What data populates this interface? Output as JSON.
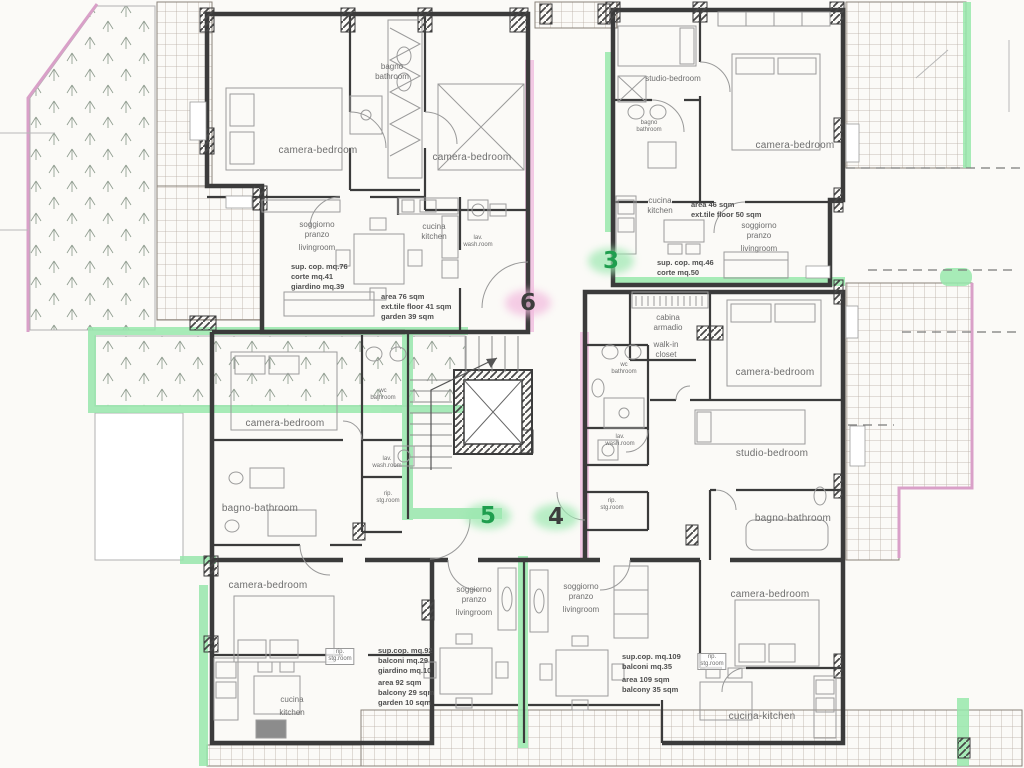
{
  "palette": {
    "wall": "#3b3b3b",
    "label_gray": "#6e6e6e",
    "stats_gray": "#4f4f4f",
    "green_highlight": "#98e7ac",
    "pink_highlight": "#f0c0e0",
    "pink_border": "#d9a0c8",
    "badge_green": "#1f9e4e",
    "badge_dark": "#3d3d3d",
    "grid_line": "#b6aca2",
    "paper": "#fbfaf7"
  },
  "badges": [
    {
      "name": "unit-badge-6",
      "value": "6",
      "x": 528,
      "y": 303,
      "color": "dark",
      "halo": "#f2b9dd"
    },
    {
      "name": "unit-badge-3",
      "value": "3",
      "x": 611,
      "y": 261,
      "color": "green",
      "halo": "#9ce8b0"
    },
    {
      "name": "unit-badge-5",
      "value": "5",
      "x": 488,
      "y": 516,
      "color": "green",
      "halo": "#9ce8b0"
    },
    {
      "name": "unit-badge-4",
      "value": "4",
      "x": 556,
      "y": 517,
      "color": "dark",
      "halo": "#9ce8b0"
    }
  ],
  "labels": [
    {
      "name": "label-bedroom-nw-left",
      "lines": [
        "camera-bedroom"
      ],
      "x": 318,
      "y": 145,
      "cls": "room"
    },
    {
      "name": "label-bath-nw",
      "lines": [
        "bagno",
        "bathroom"
      ],
      "x": 392,
      "y": 62,
      "cls": "small"
    },
    {
      "name": "label-bedroom-nw-right",
      "lines": [
        "camera-bedroom"
      ],
      "x": 472,
      "y": 152,
      "cls": "room"
    },
    {
      "name": "label-living-nw",
      "lines": [
        "soggiorno",
        "pranzo",
        "",
        "livingroom"
      ],
      "x": 317,
      "y": 220,
      "cls": "small"
    },
    {
      "name": "label-kitchen-nw",
      "lines": [
        "cucina",
        "kitchen"
      ],
      "x": 434,
      "y": 222,
      "cls": "small"
    },
    {
      "name": "label-washroom-nw",
      "lines": [
        "lav.",
        "wash.room"
      ],
      "x": 478,
      "y": 235,
      "cls": "tiny"
    },
    {
      "name": "label-stats-nw-it",
      "lines": [
        "sup. cop. mq.76",
        "corte mq.41",
        "giardino mq.39"
      ],
      "x": 291,
      "y": 262,
      "cls": "stats"
    },
    {
      "name": "label-stats-nw-en",
      "lines": [
        "area 76 sqm",
        "ext.tile floor 41 sqm",
        "garden 39 sqm"
      ],
      "x": 381,
      "y": 292,
      "cls": "stats"
    },
    {
      "name": "label-studio-ne",
      "lines": [
        "studio-bedroom"
      ],
      "x": 673,
      "y": 74,
      "cls": "small"
    },
    {
      "name": "label-bath-ne",
      "lines": [
        "bagno",
        "bathroom"
      ],
      "x": 649,
      "y": 120,
      "cls": "tiny"
    },
    {
      "name": "label-bedroom-ne",
      "lines": [
        "camera-bedroom"
      ],
      "x": 795,
      "y": 140,
      "cls": "room"
    },
    {
      "name": "label-kitchen-ne",
      "lines": [
        "cucina",
        "kitchen"
      ],
      "x": 660,
      "y": 196,
      "cls": "small"
    },
    {
      "name": "label-stats-ne-en",
      "lines": [
        "area 46 sqm",
        "ext.tile floor 50 sqm"
      ],
      "x": 691,
      "y": 200,
      "cls": "stats"
    },
    {
      "name": "label-living-ne",
      "lines": [
        "soggiorno",
        "pranzo",
        "",
        "livingroom"
      ],
      "x": 759,
      "y": 221,
      "cls": "small"
    },
    {
      "name": "label-stats-ne-it",
      "lines": [
        "sup. cop. mq.46",
        "corte mq.50"
      ],
      "x": 657,
      "y": 258,
      "cls": "stats"
    },
    {
      "name": "label-closet-e-it",
      "lines": [
        "cabina",
        "armadio"
      ],
      "x": 668,
      "y": 313,
      "cls": "small"
    },
    {
      "name": "label-closet-e-en",
      "lines": [
        "walk-in",
        "closet"
      ],
      "x": 666,
      "y": 340,
      "cls": "small"
    },
    {
      "name": "label-wc-e",
      "lines": [
        "wc",
        "bathroom"
      ],
      "x": 624,
      "y": 362,
      "cls": "tiny"
    },
    {
      "name": "label-bedroom-e",
      "lines": [
        "camera-bedroom"
      ],
      "x": 775,
      "y": 367,
      "cls": "room"
    },
    {
      "name": "label-washroom-e",
      "lines": [
        "lav.",
        "wash.room"
      ],
      "x": 620,
      "y": 434,
      "cls": "tiny"
    },
    {
      "name": "label-studio-e",
      "lines": [
        "studio-bedroom"
      ],
      "x": 772,
      "y": 448,
      "cls": "room"
    },
    {
      "name": "label-storage-e",
      "lines": [
        "rip.",
        "stg.room"
      ],
      "x": 612,
      "y": 498,
      "cls": "tiny"
    },
    {
      "name": "label-bath-e",
      "lines": [
        "bagno-bathroom"
      ],
      "x": 793,
      "y": 513,
      "cls": "room"
    },
    {
      "name": "label-bedroom-se",
      "lines": [
        "camera-bedroom"
      ],
      "x": 770,
      "y": 589,
      "cls": "room"
    },
    {
      "name": "label-storage-se",
      "lines": [
        "rip.",
        "stg.room"
      ],
      "x": 712,
      "y": 653,
      "cls": "tiny boxed"
    },
    {
      "name": "label-kitchen-se",
      "lines": [
        "cucina-kitchen"
      ],
      "x": 762,
      "y": 711,
      "cls": "room"
    },
    {
      "name": "label-bedroom-w",
      "lines": [
        "camera-bedroom"
      ],
      "x": 285,
      "y": 418,
      "cls": "room"
    },
    {
      "name": "label-wc-w",
      "lines": [
        "wc",
        "bathroom"
      ],
      "x": 383,
      "y": 388,
      "cls": "tiny"
    },
    {
      "name": "label-washroom-w",
      "lines": [
        "lav.",
        "wash.room"
      ],
      "x": 387,
      "y": 456,
      "cls": "tiny"
    },
    {
      "name": "label-storage-w",
      "lines": [
        "rip.",
        "stg.room"
      ],
      "x": 388,
      "y": 491,
      "cls": "tiny"
    },
    {
      "name": "label-bath-w",
      "lines": [
        "bagno-bathroom"
      ],
      "x": 260,
      "y": 503,
      "cls": "room"
    },
    {
      "name": "label-bedroom-sw",
      "lines": [
        "camera-bedroom"
      ],
      "x": 268,
      "y": 580,
      "cls": "room"
    },
    {
      "name": "label-storage-sw",
      "lines": [
        "rip.",
        "stg.room"
      ],
      "x": 340,
      "y": 648,
      "cls": "tiny boxed"
    },
    {
      "name": "label-kitchen-sw",
      "lines": [
        "cucina",
        "",
        "kitchen"
      ],
      "x": 292,
      "y": 695,
      "cls": "small"
    },
    {
      "name": "label-living-s-left",
      "lines": [
        "soggiorno",
        "pranzo",
        "",
        "livingroom"
      ],
      "x": 474,
      "y": 585,
      "cls": "small"
    },
    {
      "name": "label-living-s-right",
      "lines": [
        "soggiorno",
        "pranzo",
        "",
        "livingroom"
      ],
      "x": 581,
      "y": 582,
      "cls": "small"
    },
    {
      "name": "label-stats-sw-it",
      "lines": [
        "sup.cop. mq.92",
        "balconi mq.29",
        "giardino mq.10"
      ],
      "x": 378,
      "y": 646,
      "cls": "stats"
    },
    {
      "name": "label-stats-sw-en",
      "lines": [
        "area 92 sqm",
        "balcony 29 sqm",
        "garden 10 sqm"
      ],
      "x": 378,
      "y": 678,
      "cls": "stats"
    },
    {
      "name": "label-stats-se-it",
      "lines": [
        "sup.cop. mq.109",
        "balconi mq.35"
      ],
      "x": 622,
      "y": 652,
      "cls": "stats"
    },
    {
      "name": "label-stats-se-en",
      "lines": [
        "area 109 sqm",
        "balcony 35 sqm"
      ],
      "x": 622,
      "y": 675,
      "cls": "stats"
    }
  ]
}
